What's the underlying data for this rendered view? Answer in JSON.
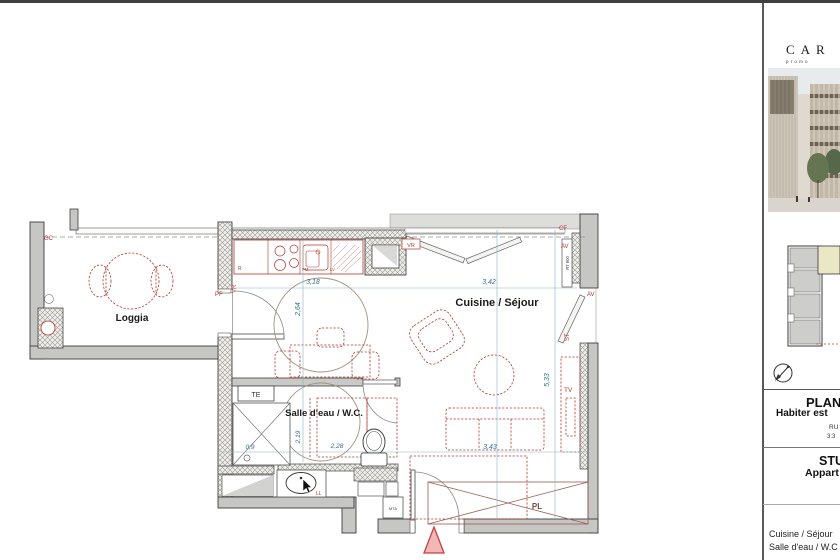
{
  "plan": {
    "rooms": {
      "loggia": "Loggia",
      "kitchen_living": "Cuisine / Séjour",
      "bathroom": "Salle d'eau / W.C."
    },
    "openings": {
      "gc": "GC",
      "pf": "PF",
      "vr_side": "VR",
      "vr_top": "VR",
      "cf": "CF",
      "av_top": "AV",
      "av_right": "AV",
      "st": "ST"
    },
    "equipment": {
      "te": "TE",
      "mta": "MTA",
      "radiator": "RT 900",
      "tv": "TV",
      "pl": "PL",
      "ll": "LL",
      "fridge": "R",
      "pm": "PM",
      "dishwasher": "LV"
    },
    "dimensions": {
      "kitchen_width": "3,18",
      "kitchen_depth": "2,64",
      "living_width": "3,42",
      "living_depth": "5,33",
      "shower_width": "0,9",
      "bath_depth": "2,19",
      "bath_width": "2,28",
      "sofa_width": "3,43"
    }
  },
  "sidebar": {
    "logo": {
      "name": "CAR",
      "tagline": "promo"
    },
    "info": {
      "title": "PLAN",
      "subtitle": "Habiter est",
      "ref_line1": "RU",
      "ref_line2": "3:3"
    },
    "unit": {
      "type": "STU",
      "label": "Appart"
    },
    "room_table": {
      "rows": [
        {
          "label": "Cuisine / Séjour"
        },
        {
          "label": "Salle d'eau / W.C"
        }
      ]
    }
  },
  "colors": {
    "accent_red": "#b4372e",
    "dim_blue": "#2e6e91",
    "wall_gray": "#c6c6c4",
    "unit_highlight": "#eae8c4"
  }
}
